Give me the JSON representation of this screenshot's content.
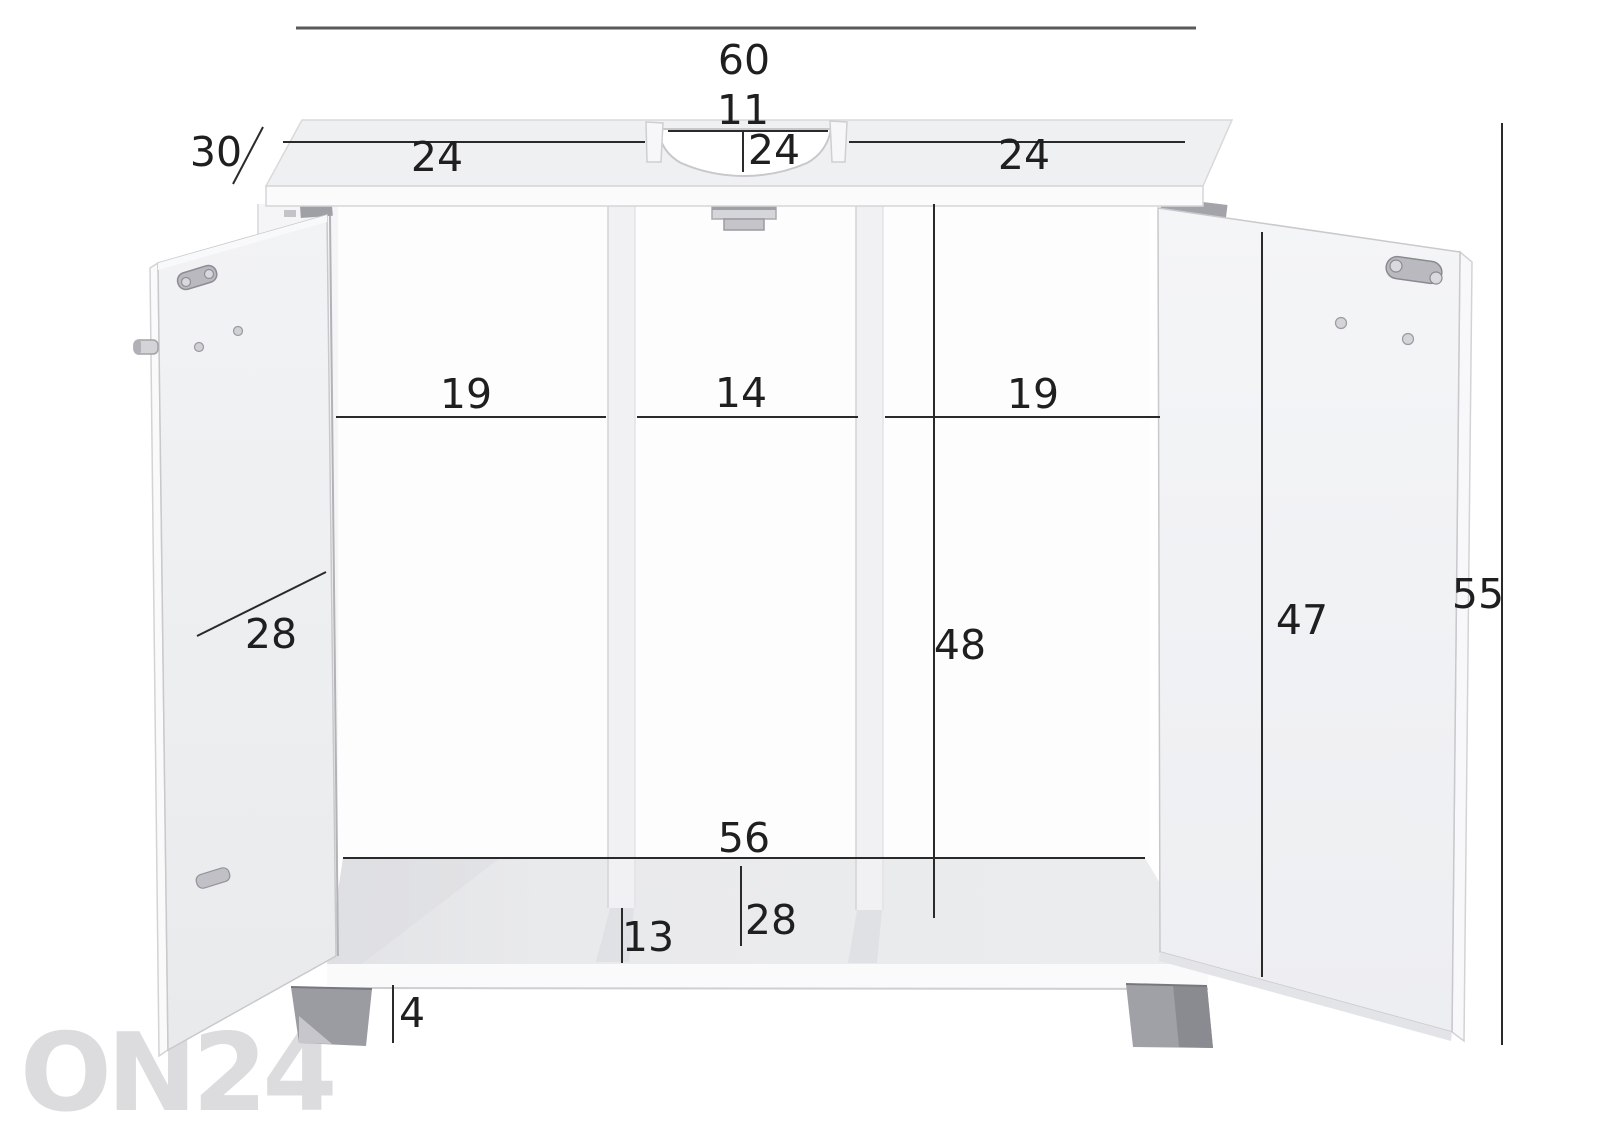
{
  "title": "Sink cabinet dimension diagram",
  "watermark": {
    "text": "ON24"
  },
  "colors": {
    "background": "#ffffff",
    "dimension_line": "#2a2a2a",
    "dimension_text": "#1f1f1f",
    "watermark": "#dcdcde",
    "cabinet_top_face": "#eff0f2",
    "cabinet_front_face": "#fbfbfc",
    "door_face": "#eef0f2",
    "shelf_top": "#e9eaec",
    "divider": "#f1f1f4",
    "foot": "#9b9ba2",
    "hinge_metal": "#b9b9bf"
  },
  "dims": {
    "total_width": {
      "value": "60",
      "meaning": "overall width"
    },
    "cutout_width": {
      "value": "11",
      "meaning": "sink cutout width"
    },
    "top_left_section": {
      "value": "24",
      "meaning": "top left section width"
    },
    "top_center_section": {
      "value": "24",
      "meaning": "top center depth at cutout"
    },
    "top_right_section": {
      "value": "24",
      "meaning": "top right section width"
    },
    "depth": {
      "value": "30",
      "meaning": "cabinet depth"
    },
    "left_compartment": {
      "value": "19",
      "meaning": "left compartment width"
    },
    "middle_compartment": {
      "value": "14",
      "meaning": "middle compartment width"
    },
    "right_compartment": {
      "value": "19",
      "meaning": "right compartment width"
    },
    "left_door_width": {
      "value": "28",
      "meaning": "door width"
    },
    "interior_height": {
      "value": "48",
      "meaning": "interior height"
    },
    "right_door_height": {
      "value": "47",
      "meaning": "door height"
    },
    "total_height": {
      "value": "55",
      "meaning": "overall height"
    },
    "bottom_shelf_width": {
      "value": "56",
      "meaning": "bottom shelf width"
    },
    "bottom_shelf_depth": {
      "value": "28",
      "meaning": "bottom shelf depth"
    },
    "bottom_clearance": {
      "value": "13",
      "meaning": "bottom panel height"
    },
    "foot_height": {
      "value": "4",
      "meaning": "foot height"
    }
  }
}
